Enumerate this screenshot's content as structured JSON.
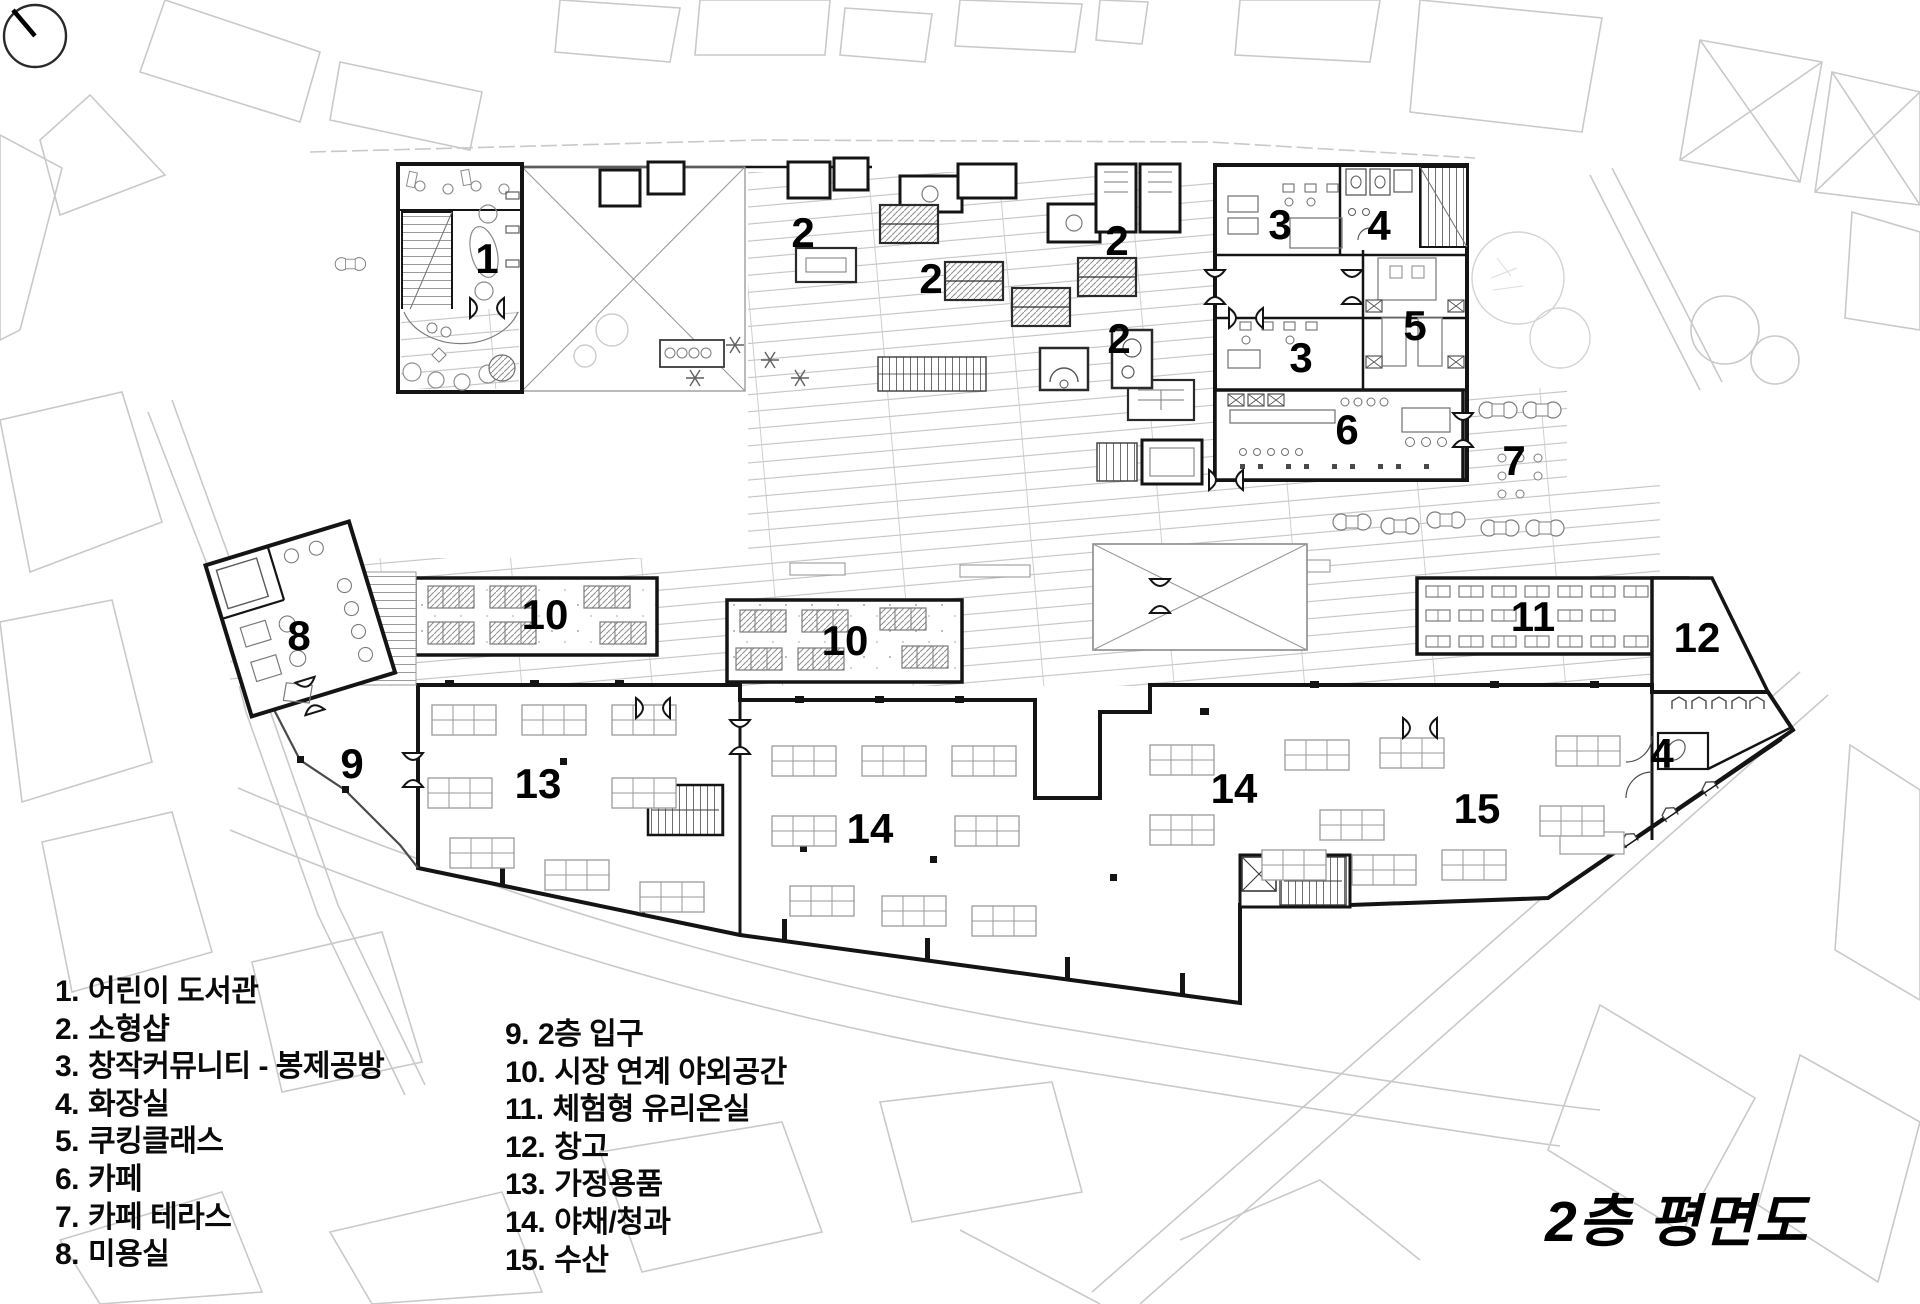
{
  "title": {
    "text": "2층 평면도"
  },
  "north_indicator": {
    "icon": "north-arrow-compass-icon"
  },
  "legend": {
    "columns": [
      {
        "items": [
          {
            "num": "1.",
            "label": "어린이 도서관"
          },
          {
            "num": "2.",
            "label": "소형샵"
          },
          {
            "num": "3.",
            "label": "창작커뮤니티 - 봉제공방"
          },
          {
            "num": "4.",
            "label": "화장실"
          },
          {
            "num": "5.",
            "label": "쿠킹클래스"
          },
          {
            "num": "6.",
            "label": "카페"
          },
          {
            "num": "7.",
            "label": "카페 테라스"
          },
          {
            "num": "8.",
            "label": "미용실"
          }
        ]
      },
      {
        "items": [
          {
            "num": "9.",
            "label": "2층 입구"
          },
          {
            "num": "10.",
            "label": "시장 연계 야외공간"
          },
          {
            "num": "11.",
            "label": "체험형 유리온실"
          },
          {
            "num": "12.",
            "label": "창고"
          },
          {
            "num": "13.",
            "label": "가정용품"
          },
          {
            "num": "14.",
            "label": "야채/청과"
          },
          {
            "num": "15.",
            "label": "수산"
          }
        ]
      }
    ]
  },
  "plan": {
    "room_labels": [
      {
        "n": "1",
        "x": 487,
        "y": 273
      },
      {
        "n": "2",
        "x": 803,
        "y": 247
      },
      {
        "n": "2",
        "x": 931,
        "y": 293
      },
      {
        "n": "2",
        "x": 1117,
        "y": 255
      },
      {
        "n": "2",
        "x": 1119,
        "y": 353
      },
      {
        "n": "3",
        "x": 1280,
        "y": 239
      },
      {
        "n": "3",
        "x": 1301,
        "y": 372
      },
      {
        "n": "4",
        "x": 1379,
        "y": 240
      },
      {
        "n": "5",
        "x": 1415,
        "y": 340
      },
      {
        "n": "6",
        "x": 1347,
        "y": 444
      },
      {
        "n": "7",
        "x": 1514,
        "y": 475
      },
      {
        "n": "8",
        "x": 299,
        "y": 650
      },
      {
        "n": "9",
        "x": 352,
        "y": 778
      },
      {
        "n": "10",
        "x": 545,
        "y": 629
      },
      {
        "n": "10",
        "x": 845,
        "y": 655
      },
      {
        "n": "11",
        "x": 1533,
        "y": 631
      },
      {
        "n": "12",
        "x": 1697,
        "y": 652
      },
      {
        "n": "13",
        "x": 538,
        "y": 798
      },
      {
        "n": "14",
        "x": 870,
        "y": 843
      },
      {
        "n": "14",
        "x": 1234,
        "y": 803
      },
      {
        "n": "15",
        "x": 1477,
        "y": 823
      },
      {
        "n": "4",
        "x": 1662,
        "y": 768
      }
    ]
  },
  "colors": {
    "wall": "#141414",
    "hatch_line": "#c4c4c4",
    "site_line": "#c9c9c9",
    "furniture_line": "#999999",
    "text": "#000000",
    "paper": "#ffffff"
  }
}
